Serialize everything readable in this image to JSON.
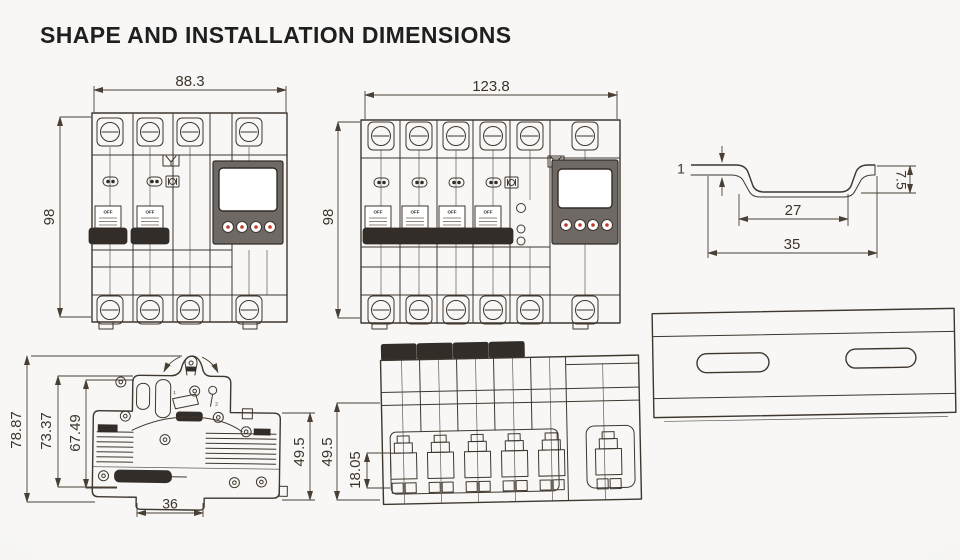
{
  "title": "SHAPE AND INSTALLATION DIMENSIONS",
  "labels": {
    "switch": "OFF"
  },
  "colors": {
    "background": "#f7f6f4",
    "line": "#3f362e",
    "dim_line": "#4a3f35",
    "dark_fill": "#332d29",
    "panel_gray": "#6e6964",
    "screen_white": "#ffffff",
    "button_red": "#c0392b"
  },
  "views": {
    "front2p": {
      "dim_width": "88.3",
      "dim_height": "98"
    },
    "front4p": {
      "dim_width": "123.8",
      "dim_height": "98"
    },
    "rail_profile": {
      "dim_thickness": "1",
      "dim_height": "7.5",
      "dim_inner_width": "27",
      "dim_outer_width": "35"
    },
    "side": {
      "dim_total_height": "78.87",
      "dim_mid_height": "73.37",
      "dim_inner_height": "67.49",
      "dim_depth": "49.5",
      "dim_foot_width": "36",
      "mech_label_1": "1",
      "mech_label_2": "2"
    },
    "bottom": {
      "dim_depth": "49.5",
      "dim_terminal_depth": "18.05"
    }
  }
}
